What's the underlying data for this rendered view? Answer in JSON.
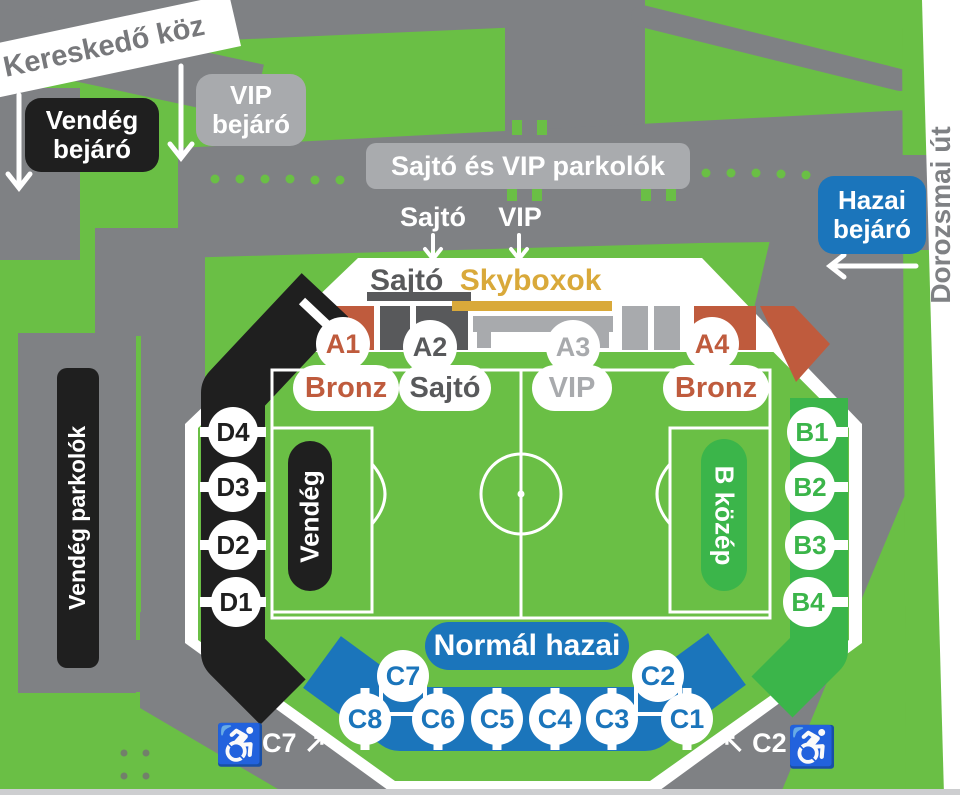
{
  "palette": {
    "map_green": "#6abf45",
    "stand_green": "#3bb54a",
    "road_gray": "#7f8184",
    "light_gray": "#a8aaad",
    "dark_gray": "#58595b",
    "black": "#1f1f1f",
    "blue": "#1b75bb",
    "terracotta": "#bf5b3d",
    "gold": "#d9a93a"
  },
  "streets": {
    "kereskedo_koz": "Kereskedő köz",
    "dorozsmai_ut": "Dorozsmai út"
  },
  "badges": {
    "vendeg_bejaro": "Vendég bejáró",
    "vip_bejaro": "VIP bejáró",
    "sajto_vip_parkolok": "Sajtó és VIP parkolók",
    "hazai_bejaro": "Hazai bejáró",
    "vendeg_parkolok": "Vendég parkolók"
  },
  "gate_labels": {
    "sajto": "Sajtó",
    "vip": "VIP"
  },
  "stadium": {
    "roof_sajto": "Sajtó",
    "roof_skyboxok": "Skyboxok",
    "sections_a": [
      {
        "label": "A1",
        "color": "#bf5b3d"
      },
      {
        "label": "A2",
        "color": "#58595b"
      },
      {
        "label": "A3",
        "color": "#a8aaad"
      },
      {
        "label": "A4",
        "color": "#bf5b3d"
      }
    ],
    "pills": [
      {
        "label": "Bronz",
        "color": "#bf5b3d"
      },
      {
        "label": "Sajtó",
        "color": "#58595b"
      },
      {
        "label": "VIP",
        "color": "#a8aaad"
      },
      {
        "label": "Bronz",
        "color": "#bf5b3d"
      }
    ],
    "sections_d": [
      {
        "label": "D4"
      },
      {
        "label": "D3"
      },
      {
        "label": "D2"
      },
      {
        "label": "D1"
      }
    ],
    "sections_b": [
      {
        "label": "B1"
      },
      {
        "label": "B2"
      },
      {
        "label": "B3"
      },
      {
        "label": "B4"
      }
    ],
    "sections_c": [
      {
        "label": "C8"
      },
      {
        "label": "C6"
      },
      {
        "label": "C5"
      },
      {
        "label": "C4"
      },
      {
        "label": "C3"
      },
      {
        "label": "C1"
      }
    ],
    "sections_c_upper": [
      {
        "label": "C7"
      },
      {
        "label": "C2"
      }
    ],
    "area_vendeg": "Vendég",
    "area_b_kozep": "B közép",
    "area_normal_hazai": "Normál hazai"
  },
  "access": {
    "wheelchair_icon": "♿",
    "left_label": "C7 ↗",
    "right_label": "↖ C2"
  }
}
